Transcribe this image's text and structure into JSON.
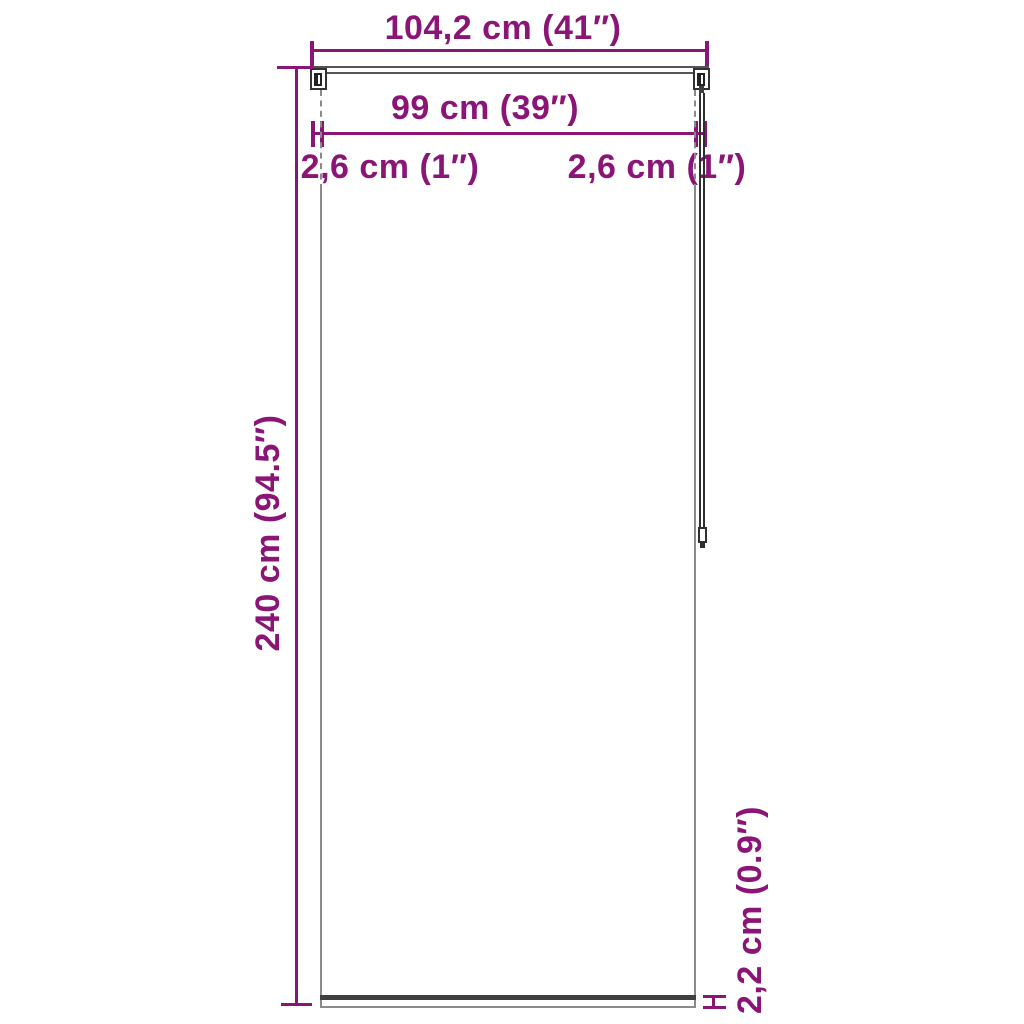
{
  "diagram": {
    "type": "product-dimension-diagram",
    "subject": "roller blind front view with mounting brackets, pull cord and bottom bar",
    "colors": {
      "accent": "#8B1577",
      "line": "#3f3f3f",
      "edge": "#8a8a8a"
    },
    "labels": {
      "total_width": "104,2 cm (41″)",
      "fabric_width": "99 cm (39″)",
      "gap_left": "2,6 cm (1″)",
      "gap_right": "2,6 cm (1″)",
      "height": "240 cm (94.5″)",
      "bottom_bar": "2,2 cm (0.9″)"
    }
  }
}
